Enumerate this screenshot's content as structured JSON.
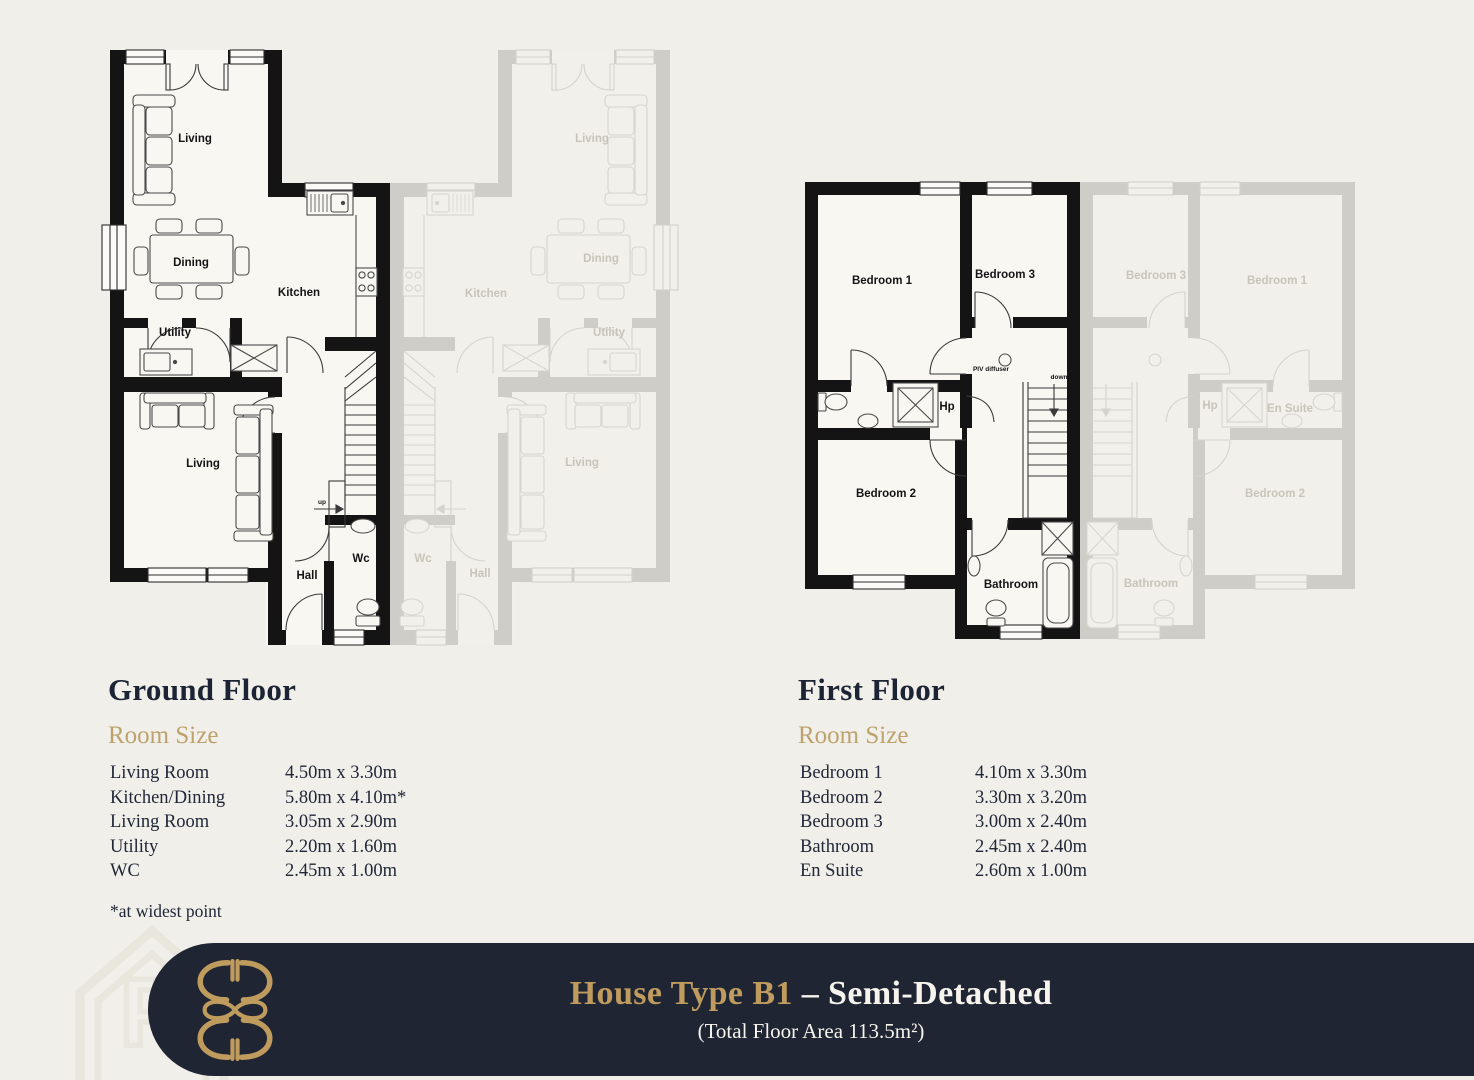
{
  "colors": {
    "background": "#f1efe9",
    "heading_navy": "#1c2334",
    "accent_gold": "#bda26e",
    "banner_navy": "#1f2532",
    "banner_gold": "#bf9b5e",
    "banner_white": "#f6f4ed",
    "plan_line": "#141414"
  },
  "ground_floor": {
    "title": "Ground Floor",
    "room_size_label": "Room Size",
    "rooms": [
      {
        "name": "Living Room",
        "size": "4.50m x 3.30m"
      },
      {
        "name": "Kitchen/Dining",
        "size": "5.80m x 4.10m*"
      },
      {
        "name": "Living Room",
        "size": "3.05m x 2.90m"
      },
      {
        "name": "Utility",
        "size": "2.20m x 1.60m"
      },
      {
        "name": "WC",
        "size": "2.45m x 1.00m"
      }
    ],
    "footnote": "*at widest point",
    "plan_labels": {
      "living_top": "Living",
      "dining": "Dining",
      "kitchen": "Kitchen",
      "utility": "Utility",
      "living_bottom": "Living",
      "hall": "Hall",
      "wc": "Wc",
      "up": "up"
    }
  },
  "first_floor": {
    "title": "First Floor",
    "room_size_label": "Room Size",
    "rooms": [
      {
        "name": "Bedroom 1",
        "size": "4.10m x 3.30m"
      },
      {
        "name": "Bedroom 2",
        "size": "3.30m x 3.20m"
      },
      {
        "name": "Bedroom 3",
        "size": "3.00m x 2.40m"
      },
      {
        "name": "Bathroom",
        "size": "2.45m x 2.40m"
      },
      {
        "name": "En Suite",
        "size": "2.60m x 1.00m"
      }
    ],
    "plan_labels": {
      "bedroom_1": "Bedroom 1",
      "bedroom_2": "Bedroom 2",
      "bedroom_3": "Bedroom 3",
      "bathroom": "Bathroom",
      "en_suite": "En Suite",
      "hp": "Hp",
      "piv_diffuser": "PIV diffuser",
      "down": "down"
    }
  },
  "footer": {
    "title_gold": "House Type B1",
    "title_white": "– Semi-Detached",
    "subtitle": "(Total Floor Area 113.5m²)"
  }
}
